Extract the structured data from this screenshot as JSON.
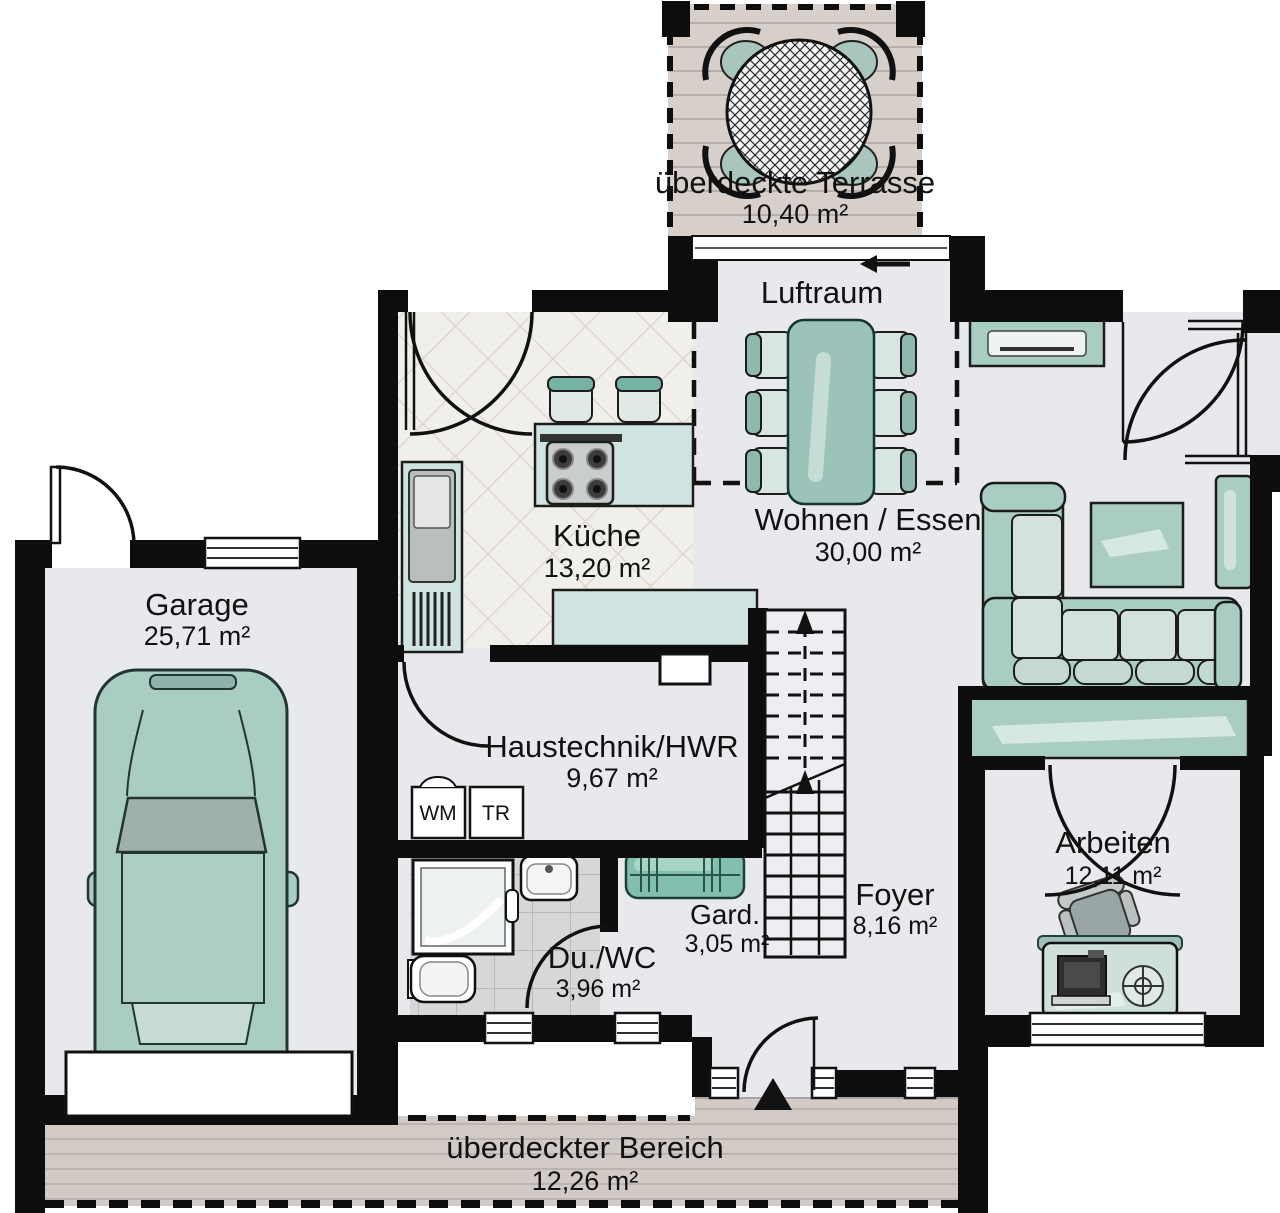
{
  "rooms": {
    "terrasse": {
      "name": "überdeckte Terrasse",
      "area": "10,40 m²"
    },
    "luftraum": {
      "name": "Luftraum"
    },
    "kueche": {
      "name": "Küche",
      "area": "13,20 m²"
    },
    "wohnen_essen": {
      "name": "Wohnen / Essen",
      "area": "30,00 m²"
    },
    "garage": {
      "name": "Garage",
      "area": "25,71 m²"
    },
    "haustechnik": {
      "name": "Haustechnik/HWR",
      "area": "9,67 m²"
    },
    "gard": {
      "name": "Gard.",
      "area": "3,05 m²"
    },
    "du_wc": {
      "name": "Du./WC",
      "area": "3,96 m²"
    },
    "foyer": {
      "name": "Foyer",
      "area": "8,16 m²"
    },
    "arbeiten": {
      "name": "Arbeiten",
      "area": "12,11 m²"
    },
    "bereich": {
      "name": "überdeckter Bereich",
      "area": "12,26 m²"
    }
  },
  "appliances": {
    "washer": "WM",
    "dryer": "TR"
  },
  "colors": {
    "wall": "#0d0d0d",
    "floor": "#e7e9ed",
    "furniture": "#a9cdc3",
    "furniture_light": "#d3e2dc",
    "accent_green": "#82bfae",
    "terrace_wood": "#d7d0ca",
    "deck_wood": "#d2cac5",
    "bath_tile": "#d7d7d7",
    "kitchen_tile": "#f1efeb"
  }
}
